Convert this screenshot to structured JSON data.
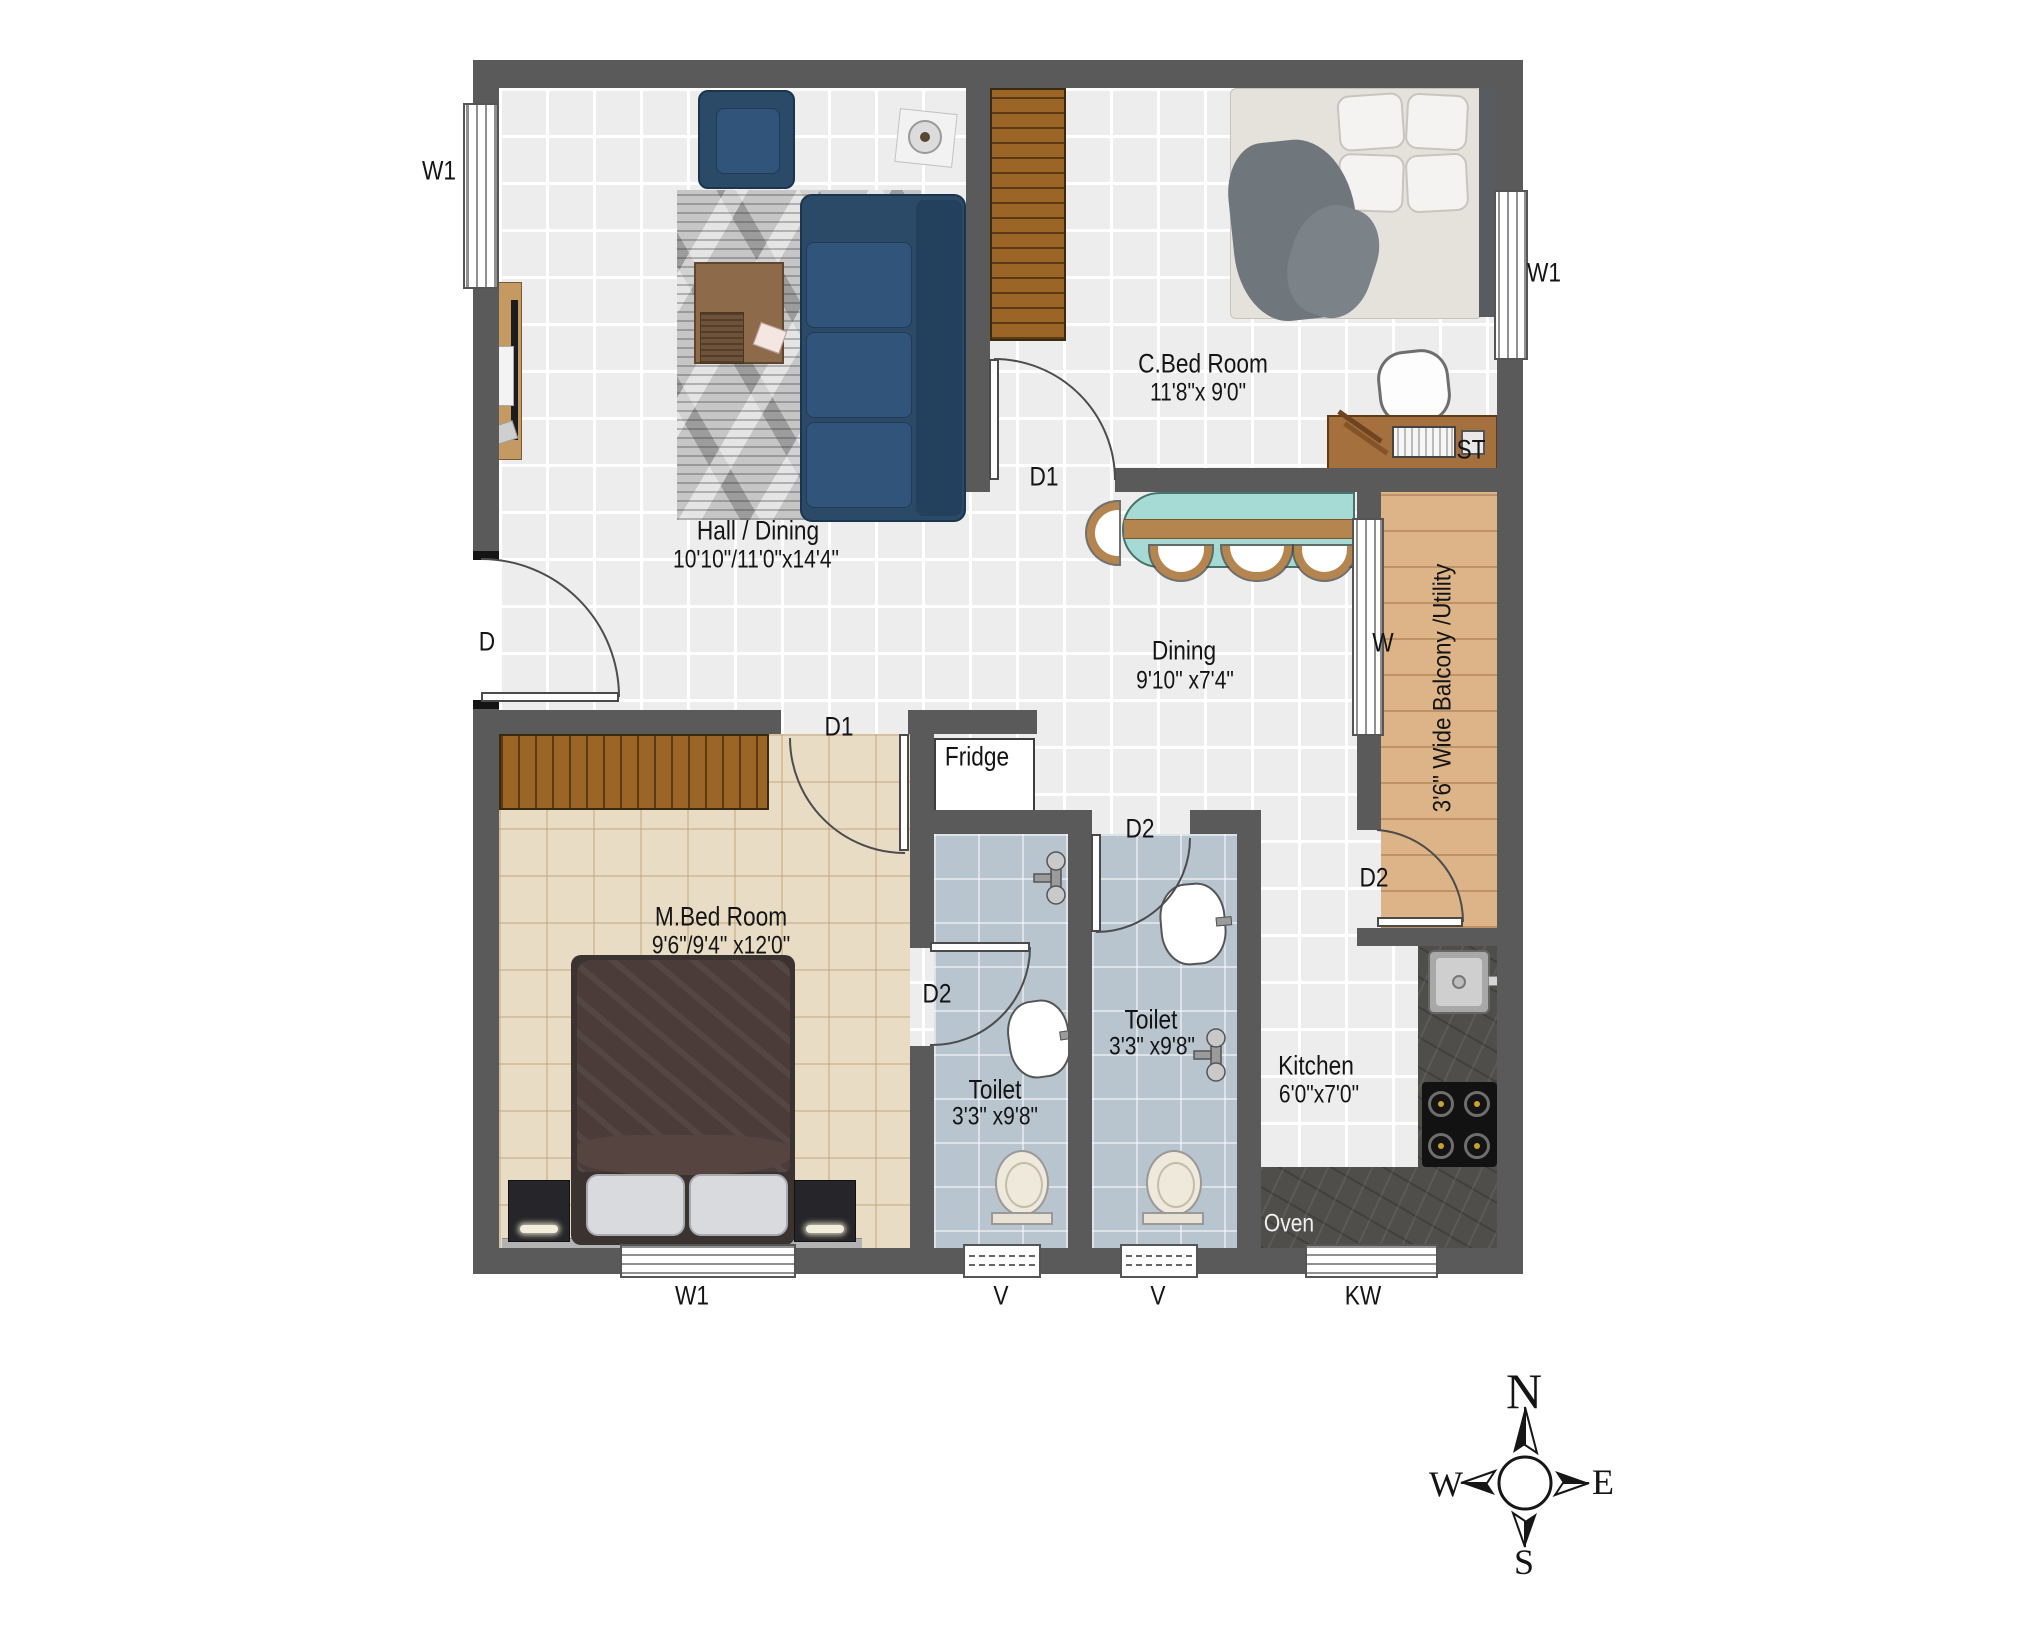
{
  "rooms": {
    "hall": {
      "name": "Hall / Dining",
      "dims": "10'10\"/11'0\"x14'4\""
    },
    "cbed": {
      "name": "C.Bed Room",
      "dims": "11'8\"x 9'0\""
    },
    "mbed": {
      "name": "M.Bed Room",
      "dims": "9'6\"/9'4\" x12'0\""
    },
    "dining": {
      "name": "Dining",
      "dims": "9'10\" x7'4\""
    },
    "toilet_left": {
      "name": "Toilet",
      "dims": "3'3\" x9'8\""
    },
    "toilet_right": {
      "name": "Toilet",
      "dims": "3'3\" x9'8\""
    },
    "kitchen": {
      "name": "Kitchen",
      "dims": "6'0\"x7'0\""
    },
    "balcony": {
      "name": "3'6\" Wide Balcony /Utility"
    }
  },
  "doors": {
    "main": "D",
    "cbed": "D1",
    "mbed": "D1",
    "toilet_left": "D2",
    "toilet_right": "D2",
    "balcony": "D2"
  },
  "windows": {
    "left_w1": "W1",
    "right_w1": "W1",
    "bottom_w1": "W1",
    "vent_left": "V",
    "vent_right": "V",
    "kitchen_kw": "KW",
    "dining_w": "W"
  },
  "appliances": {
    "fridge": "Fridge",
    "oven": "Oven",
    "study_table": "ST"
  },
  "compass": {
    "north": "N",
    "east": "E",
    "south": "S",
    "west": "W"
  },
  "colors": {
    "wall": "#5a5a5a",
    "hall_floor": "#ededee",
    "mbed_floor": "#e9dcc5",
    "toilet_floor": "#b9c5ce",
    "balcony_floor": "#dcb487",
    "counter": "#504e4b",
    "sofa": "#2b4a68",
    "dining_table": "#a6dad4",
    "wood_trim": "#b5854f"
  }
}
